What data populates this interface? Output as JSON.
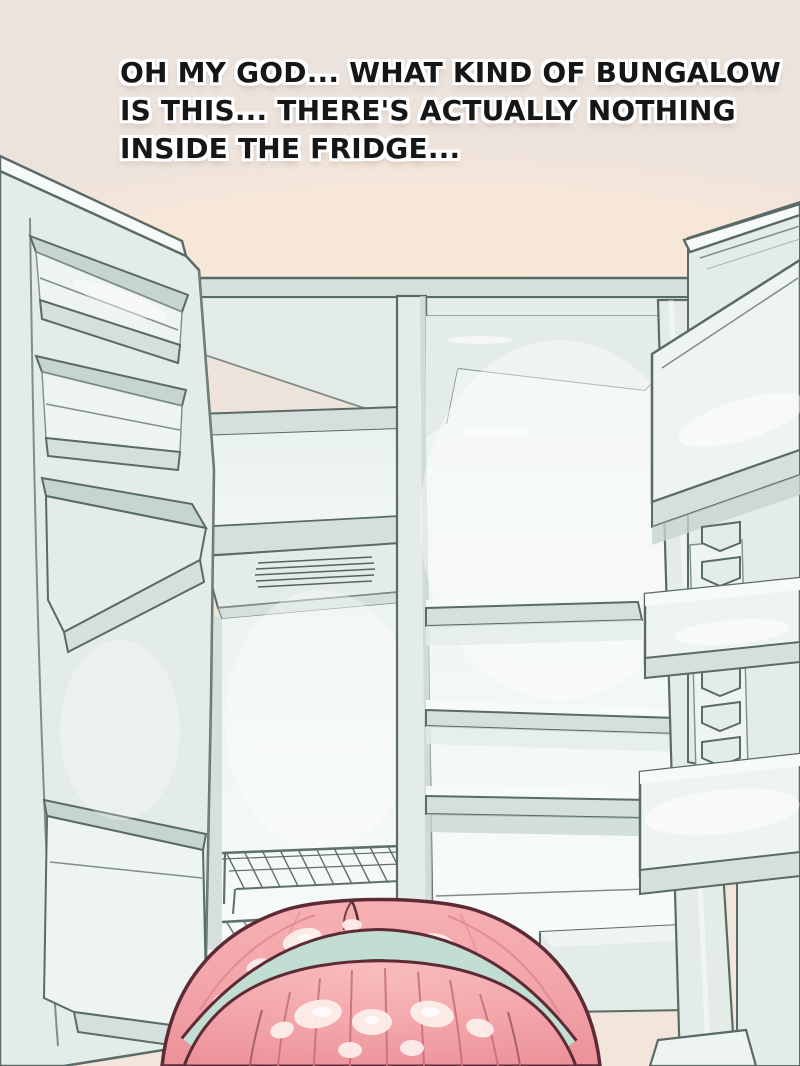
{
  "panel": {
    "dialogue": {
      "lines": [
        "OH MY GOD... WHAT KIND OF BUNGALOW",
        "IS THIS... THERE'S ACTUALLY NOTHING",
        "INSIDE THE FRIDGE..."
      ]
    },
    "colors": {
      "wall": "#ece4dd",
      "ceiling_pink": "#f8e7d8",
      "line_dark": "#5a6a66",
      "line_soft": "#7f8e8a",
      "fridge_face": "#e4ece8",
      "fridge_mid": "#d5e0dc",
      "fridge_deep": "#c7d5d0",
      "fridge_light": "#eef4f1",
      "fridge_bright": "#f6faf8",
      "hair_base": "#f2a5a9",
      "hair_shade": "#ec9199",
      "hair_strand": "#c6717b",
      "hair_outline": "#5d2b35",
      "hair_highlight": "#fdeeea",
      "headband": "#c2ddd2",
      "text_ink": "#161616",
      "text_halo": "#ffffff"
    }
  }
}
